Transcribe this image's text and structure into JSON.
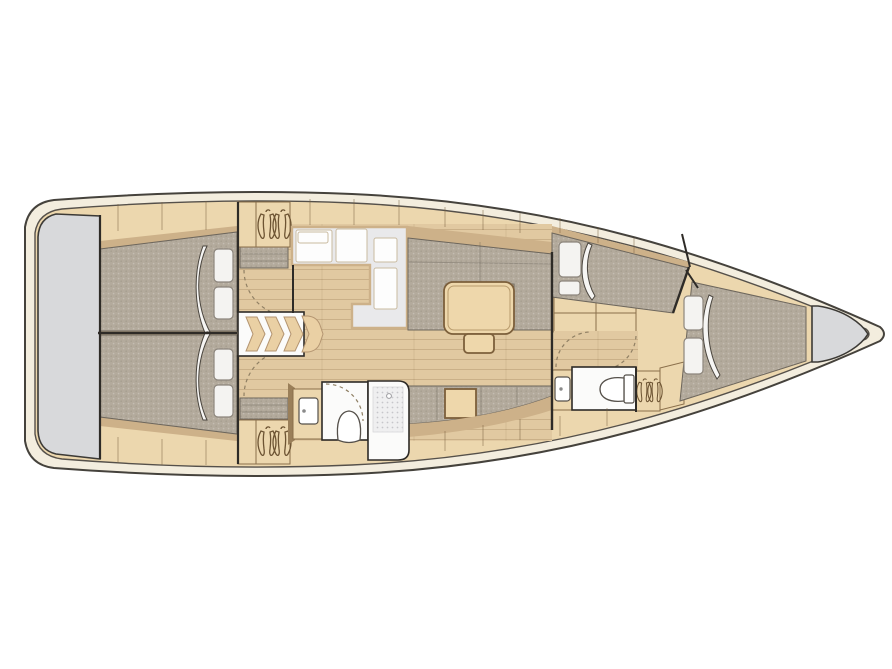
{
  "canvas": {
    "width": 892,
    "height": 669,
    "background": "#ffffff"
  },
  "colors": {
    "hull_outline": "#45423c",
    "deck_cream": "#f3edde",
    "wood_base": "#ecd7ae",
    "wood_mid": "#dfc79d",
    "wood_dark": "#cdb189",
    "floor_wood": "#e1c9a1",
    "wall_dark": "#2e2b27",
    "fabric_gray": "#b3aa9c",
    "fabric_edge": "#6d665c",
    "counter_gray": "#e9e9eb",
    "room_white": "#fbfbfa",
    "appliance_white": "#fdfdfd",
    "transom_gray": "#d8d9db",
    "table_wood": "#eed7ab",
    "table_edge": "#7c5f3b",
    "trim_line": "#8a6f4b",
    "fixture_line": "#55504a",
    "dash_line": "#8f7f63",
    "step_wood": "#ead0a4",
    "step_edge": "#b49571",
    "shower_base": "#efeff0",
    "shower_dot": "#c6c6ca"
  },
  "icons": {
    "hanger_icon": "stylized clothes hanger (wardrobe)",
    "toilet_icon": "toilet bowl, top view",
    "sink_icon": "basin with faucet dot",
    "steps_icon": "companionway chevron steps",
    "door_swing_icon": "dashed quarter-circle door swing",
    "duvet_icon": "curved turned-down duvet blade",
    "pillow_icon": "rounded white pillow"
  }
}
